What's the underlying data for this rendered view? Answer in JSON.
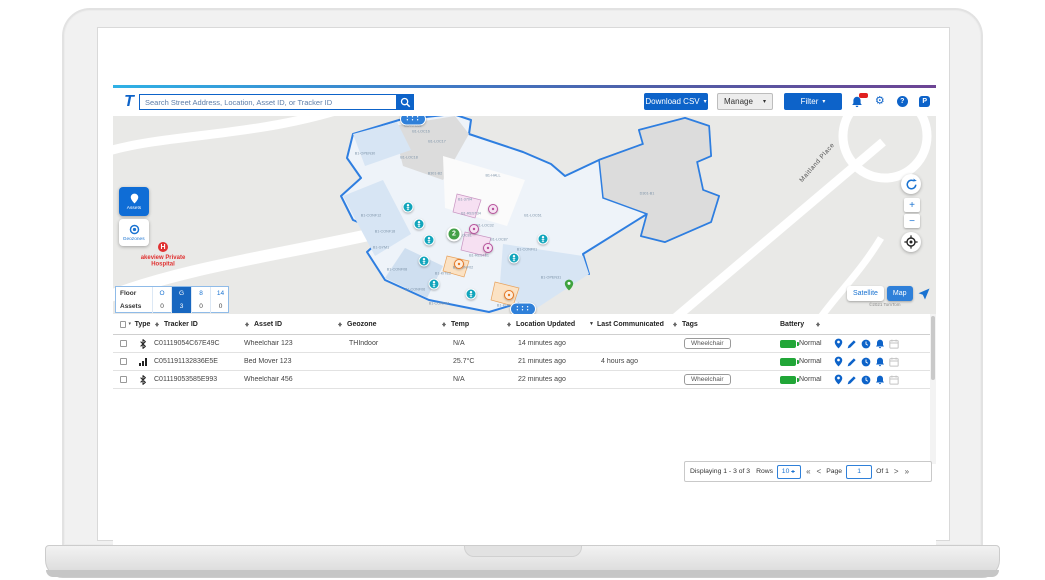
{
  "toolbar": {
    "logo": "T",
    "search_placeholder": "Search Street Address, Location, Asset ID, or Tracker ID",
    "download_csv": "Download CSV",
    "manage": "Manage",
    "filter": "Filter",
    "gear_glyph": "⚙",
    "help_glyph": "?",
    "p_glyph": "P",
    "accent_blue": "#0d63c9"
  },
  "map": {
    "assets_button": "Assets",
    "geozones_button": "Geozones",
    "hospital_marker": "H",
    "hospital_label": "akeview Private Hospital",
    "street": "Maitland Place",
    "attribution": "©2021 TomTom",
    "satellite_toggle": "Satellite",
    "map_toggle": "Map",
    "floor_panel": {
      "floor_label": "Floor",
      "assets_label": "Assets",
      "floors": [
        "O",
        "G",
        "8",
        "14"
      ],
      "assets": [
        "0",
        "3",
        "0",
        "0"
      ],
      "selected_index": 1
    },
    "rooms": [
      {
        "t": "B1-KFE81",
        "x": 300,
        "y": 10
      },
      {
        "t": "B1-LOC16",
        "x": 308,
        "y": 16
      },
      {
        "t": "B1-LOC17",
        "x": 324,
        "y": 26
      },
      {
        "t": "B1-OPEN30",
        "x": 252,
        "y": 38
      },
      {
        "t": "B1-LOC18",
        "x": 296,
        "y": 42
      },
      {
        "t": "B301-B2",
        "x": 322,
        "y": 58
      },
      {
        "t": "B1-HALL",
        "x": 380,
        "y": 60
      },
      {
        "t": "B1-3704",
        "x": 352,
        "y": 84
      },
      {
        "t": "B1-REST34",
        "x": 358,
        "y": 98
      },
      {
        "t": "B1-CONF12",
        "x": 258,
        "y": 100
      },
      {
        "t": "B1-LOC61",
        "x": 420,
        "y": 100
      },
      {
        "t": "B1-LOC32",
        "x": 372,
        "y": 110
      },
      {
        "t": "B1-CONF18",
        "x": 272,
        "y": 116
      },
      {
        "t": "B1-LOC81",
        "x": 350,
        "y": 120
      },
      {
        "t": "B1-LOC87",
        "x": 386,
        "y": 124
      },
      {
        "t": "B1-GYM1",
        "x": 268,
        "y": 132
      },
      {
        "t": "B1-REST81",
        "x": 366,
        "y": 140
      },
      {
        "t": "B1-CONF01",
        "x": 414,
        "y": 134
      },
      {
        "t": "B1-CONF02",
        "x": 350,
        "y": 152
      },
      {
        "t": "B1-CONF08",
        "x": 284,
        "y": 154
      },
      {
        "t": "B1-KITE2",
        "x": 330,
        "y": 158
      },
      {
        "t": "B1-OPEN31",
        "x": 438,
        "y": 162
      },
      {
        "t": "B1-CONF06",
        "x": 302,
        "y": 174
      },
      {
        "t": "B1-CONF04",
        "x": 326,
        "y": 188
      },
      {
        "t": "B1-KITE1",
        "x": 392,
        "y": 190
      },
      {
        "t": "D301-B1",
        "x": 534,
        "y": 78
      }
    ],
    "markers": [
      {
        "type": "asset",
        "x": 295,
        "y": 91
      },
      {
        "type": "asset",
        "x": 306,
        "y": 108
      },
      {
        "type": "asset",
        "x": 316,
        "y": 124
      },
      {
        "type": "asset",
        "x": 311,
        "y": 145
      },
      {
        "type": "asset",
        "x": 321,
        "y": 168
      },
      {
        "type": "asset",
        "x": 358,
        "y": 178
      },
      {
        "type": "asset",
        "x": 401,
        "y": 142
      },
      {
        "type": "asset",
        "x": 430,
        "y": 123
      },
      {
        "type": "rest",
        "x": 380,
        "y": 93
      },
      {
        "type": "rest",
        "x": 361,
        "y": 113
      },
      {
        "type": "rest",
        "x": 375,
        "y": 132
      },
      {
        "type": "kitchen",
        "x": 346,
        "y": 148
      },
      {
        "type": "kitchen",
        "x": 396,
        "y": 179
      },
      {
        "type": "cluster-count",
        "x": 341,
        "y": 118,
        "label": "2"
      },
      {
        "type": "green-pin",
        "x": 456,
        "y": 169
      },
      {
        "type": "cluster-dots",
        "x": 410,
        "y": 193
      },
      {
        "type": "cluster-dots",
        "x": 300,
        "y": 3
      }
    ]
  },
  "table": {
    "columns": [
      "Type",
      "Tracker ID",
      "Asset ID",
      "Geozone",
      "Temp",
      "Location Updated",
      "Last Communicated",
      "Tags",
      "Battery"
    ],
    "rows": [
      {
        "type": "bluetooth",
        "tracker_id": "C01119054C67E49C",
        "asset_id": "Wheelchair 123",
        "geozone": "THIndoor",
        "temp": "N/A",
        "location_updated": "14 minutes ago",
        "last_communicated": "",
        "tags": "Wheelchair",
        "battery": "Normal"
      },
      {
        "type": "signal",
        "tracker_id": "C051191132836E5E",
        "asset_id": "Bed Mover 123",
        "geozone": "",
        "temp": "25.7°C",
        "location_updated": "21 minutes ago",
        "last_communicated": "4 hours ago",
        "tags": "",
        "battery": "Normal"
      },
      {
        "type": "bluetooth",
        "tracker_id": "C01119053585E993",
        "asset_id": "Wheelchair 456",
        "geozone": "",
        "temp": "N/A",
        "location_updated": "22 minutes ago",
        "last_communicated": "",
        "tags": "Wheelchair",
        "battery": "Normal"
      }
    ]
  },
  "pagination": {
    "displaying": "Displaying 1 - 3 of 3",
    "rows_label": "Rows",
    "rows_value": "10",
    "first": "«",
    "prev": "<",
    "page_label": "Page",
    "page_value": "1",
    "of_label": "Of 1",
    "next": ">",
    "last": "»"
  }
}
